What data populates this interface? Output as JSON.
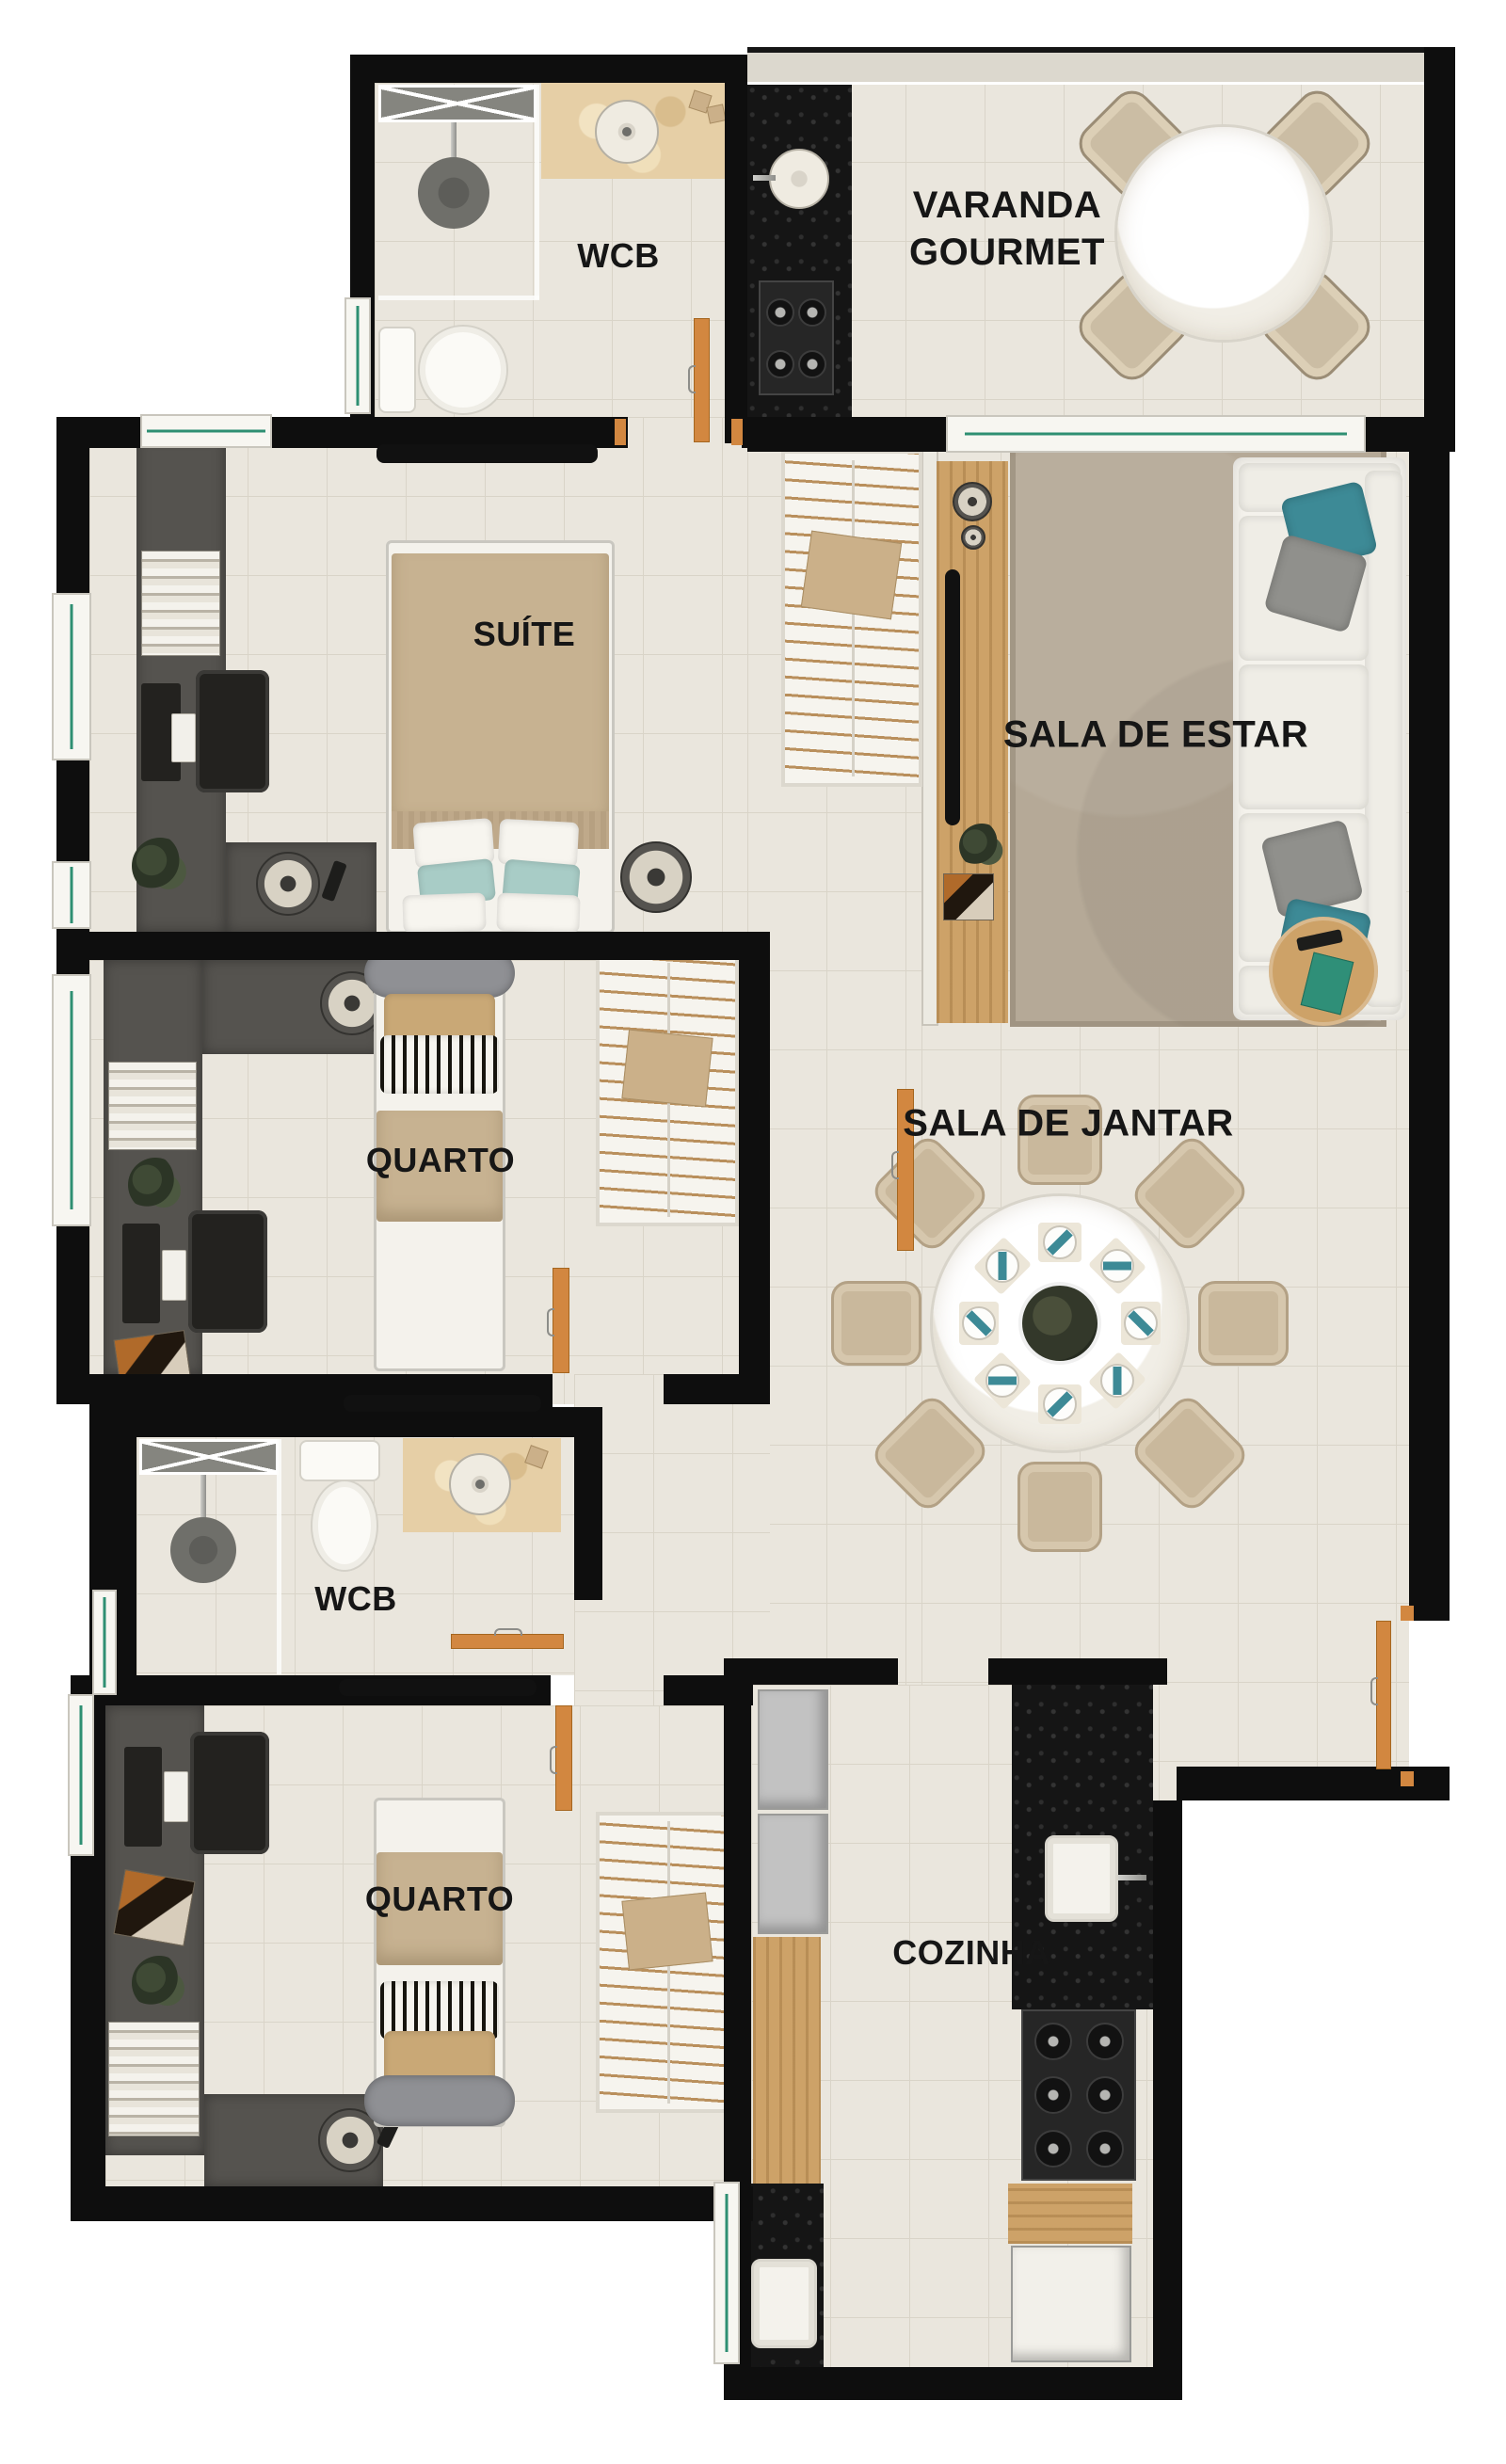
{
  "rooms": {
    "varanda_gourmet": {
      "line1": "VARANDA",
      "line2": "GOURMET"
    },
    "wcb_suite": "WCB",
    "suite": "SUÍTE",
    "sala_de_estar": "SALA DE ESTAR",
    "quarto_1": "QUARTO",
    "sala_de_jantar": "SALA DE JANTAR",
    "wcb_social": "WCB",
    "quarto_2": "QUARTO",
    "cozinha": "COZINHA"
  },
  "palette": {
    "wall": "#0e0e0e",
    "floor": "#eae6dd",
    "wood_door": "#d28740",
    "wood_furniture": "#cda268",
    "dark_counter": "#151515",
    "teal_accent": "#3d8a96",
    "rug": "#b5a997",
    "bathroom_marble": "#e6cfa6",
    "glass_green": "#2e8f72"
  }
}
